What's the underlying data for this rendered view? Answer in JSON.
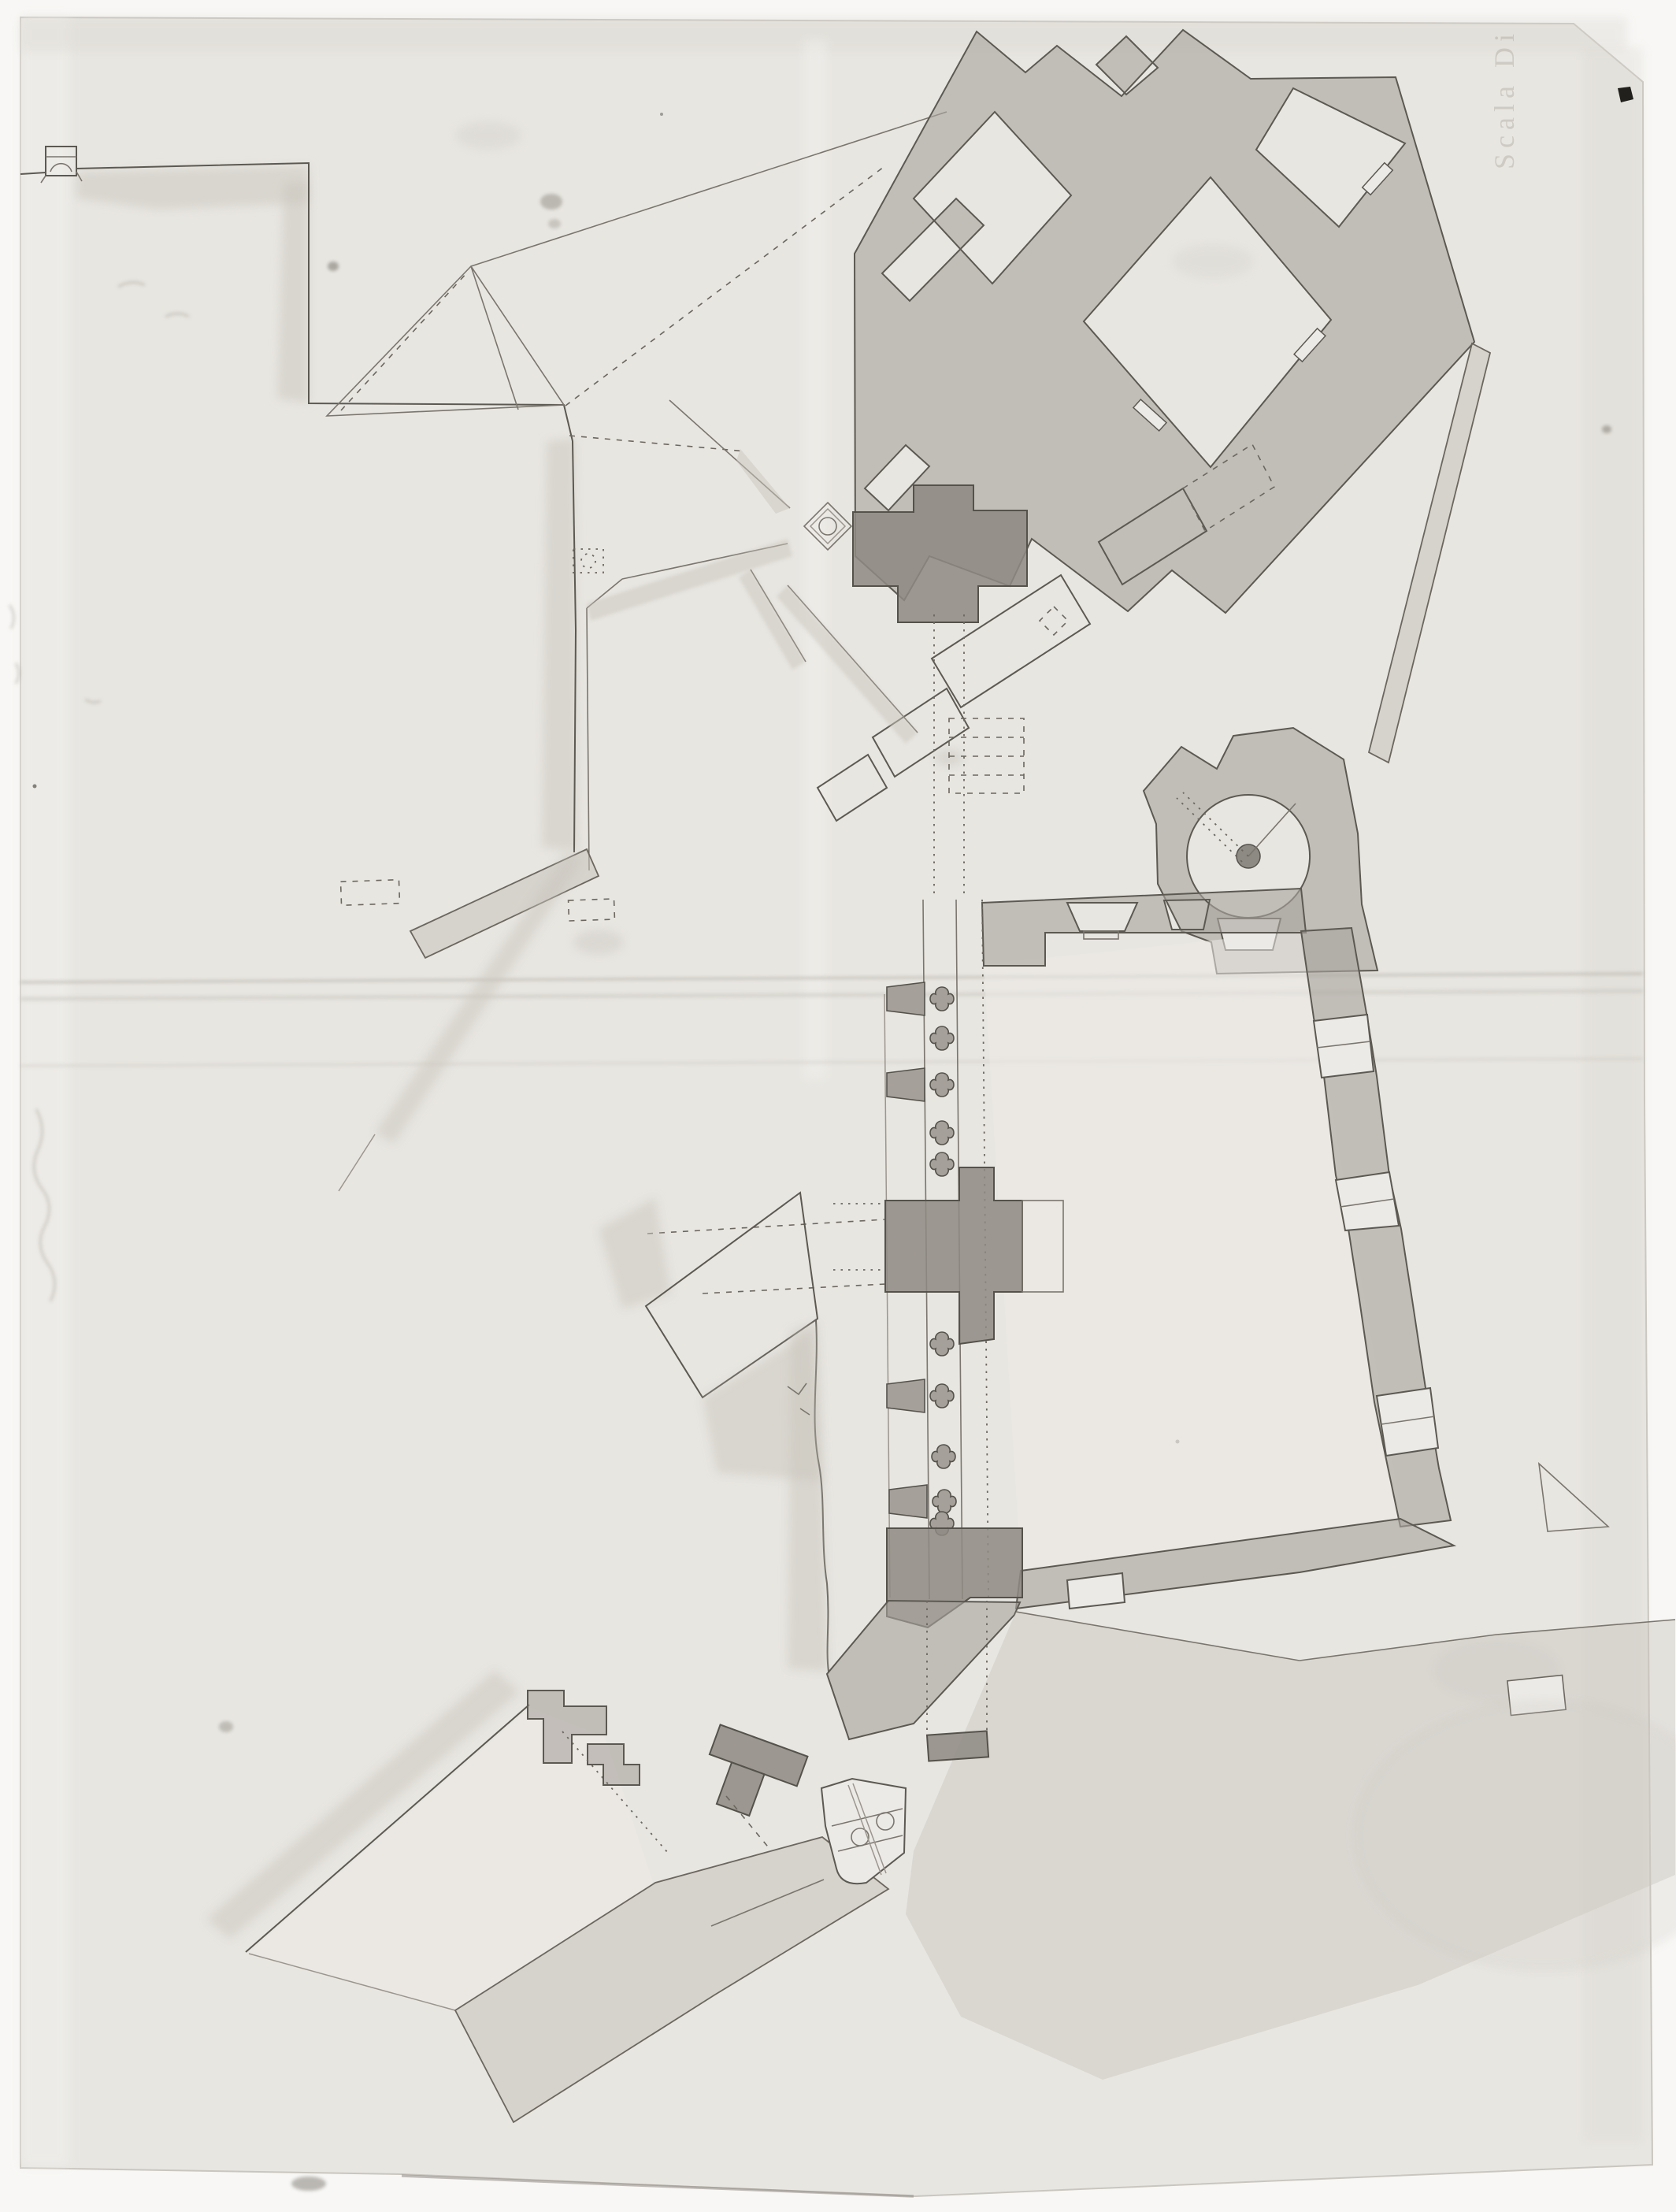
{
  "document": {
    "kind": "scanned hand-drawn architectural floor plan",
    "annotation": {
      "scale_note": "Scala Di"
    }
  },
  "colors": {
    "scan_bg": "#f8f7f5",
    "paper": "#e8e6e1",
    "paper_light": "#efeeea",
    "ink": "#5c5952",
    "ink_faint": "#8b877f",
    "poche": "#a9a59e",
    "poche_dark": "#8e8a83",
    "poche_light": "#c6c3bc",
    "wash": "#c9c5be",
    "fleck": "#21201d",
    "note_ink": "#948e82"
  }
}
